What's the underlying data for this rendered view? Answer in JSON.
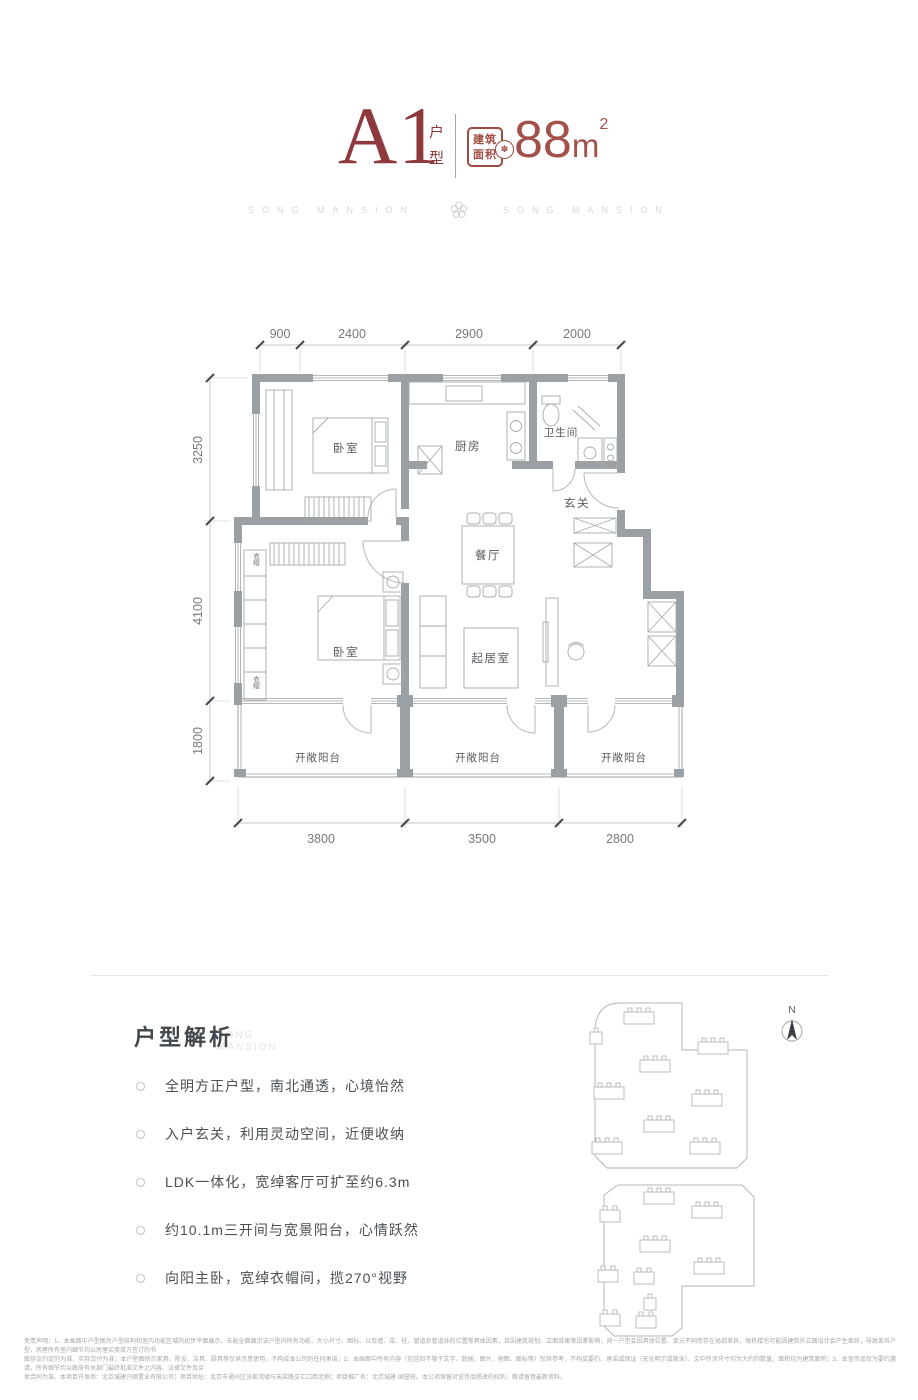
{
  "header": {
    "unit_code": "A1",
    "unit_label": "户型",
    "area_badge_line1": "建筑",
    "area_badge_line2": "面积",
    "area_value": "88",
    "area_unit": "m",
    "area_sup": "2"
  },
  "watermark": {
    "left": "SONG MANSION",
    "right": "SONG MANSION",
    "flower": "✽"
  },
  "plan": {
    "dims_top": [
      "900",
      "2400",
      "2900",
      "2000"
    ],
    "dims_left": [
      "3250",
      "4100",
      "1800"
    ],
    "dims_bottom": [
      "3800",
      "3500",
      "2800"
    ],
    "rooms": {
      "bedroom1": "卧室",
      "kitchen": "厨房",
      "bath": "卫生间",
      "entry": "玄关",
      "dining": "餐厅",
      "bedroom2": "卧室",
      "living": "起居室",
      "balcony1": "开敞阳台",
      "balcony2": "开敞阳台",
      "balcony3": "开敞阳台",
      "closet_a": "衣帽",
      "closet_b": "衣帽"
    }
  },
  "analysis": {
    "title": "户型解析",
    "watermark_line1": "SONG",
    "watermark_line2": "MANSION",
    "bullets": [
      "全明方正户型，南北通透，心境怡然",
      "入户玄关，利用灵动空间，近便收纳",
      "LDK一体化，宽绰客厅可扩至约6.3m",
      "约10.1m三开间与宽景阳台，心情跃然",
      "向阳主卧，宽绰衣帽间，揽270°视野"
    ]
  },
  "siteplan": {
    "north": "N"
  },
  "disclaimer": {
    "line1": "免责声明：1、本画面中户型图为户型结构和室内功能区域的初步平面展示，未能全面展示该户型内所有功能、大小尺寸、图标、以及墙、梁、柱、管道及管道井的位置等具体因素，且因建筑规划、立面效果等因素影响，同一户型会因具体位置、单元不同而存在局部差异，每栋楼也可能因建筑外立面设计会产生差异，导致差异户型，房屋所有室内细节均以房屋买卖双方签订的书",
    "line2": "面协议约定的为准、实际交付为准；本户型图所示家具、陈设、洁具、厨具等仅供示意使用，不构成本公司的任何承诺；2、本画面中所有内容（包括但不限于文字、数据、图片、地图、图标等）仅供参考，不构成要约、承诺或保证（无论明示或隐含），文中所涉尺寸均为大约的数值，面积均为建筑面积；3、本宣传品仅为要约邀请，所有细节均以政府有关部门最终批准文件之内容、法律文件及买",
    "line3": "卖合同为准。本项目开发商：北京城建兴顺置业有限公司；项目地址：北京市通州区张家湾镇与宋梁路交汇口西北侧；项目推广名：北京城建·国誉府。本公司保留对宣传品修改的权利，敬请留意最新资料。"
  }
}
